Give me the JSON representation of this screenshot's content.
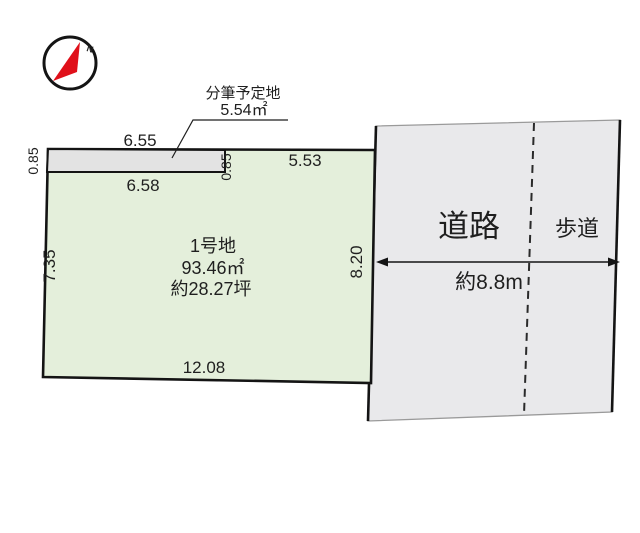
{
  "colors": {
    "plot_green": "#e4efdb",
    "strip_gray": "#e3e3e3",
    "road_gray": "#e9e9eb",
    "line_black": "#141414",
    "thin_gray": "#9a9a9a",
    "compass_red": "#e0101a"
  },
  "compass": {
    "north_label": "N"
  },
  "subdivision": {
    "label": "分筆予定地",
    "area": "5.54㎡",
    "dim_top": "6.55",
    "dim_left": "0.85",
    "dim_right": "0.85",
    "dim_bottom": "6.58"
  },
  "plot": {
    "name": "1号地",
    "area_m2": "93.46㎡",
    "area_tsubo": "約28.27坪",
    "dim_top": "5.53",
    "dim_left": "7.35",
    "dim_right": "8.20",
    "dim_bottom": "12.08"
  },
  "road": {
    "label": "道路",
    "sidewalk_label": "歩道",
    "width_label": "約8.8m"
  }
}
